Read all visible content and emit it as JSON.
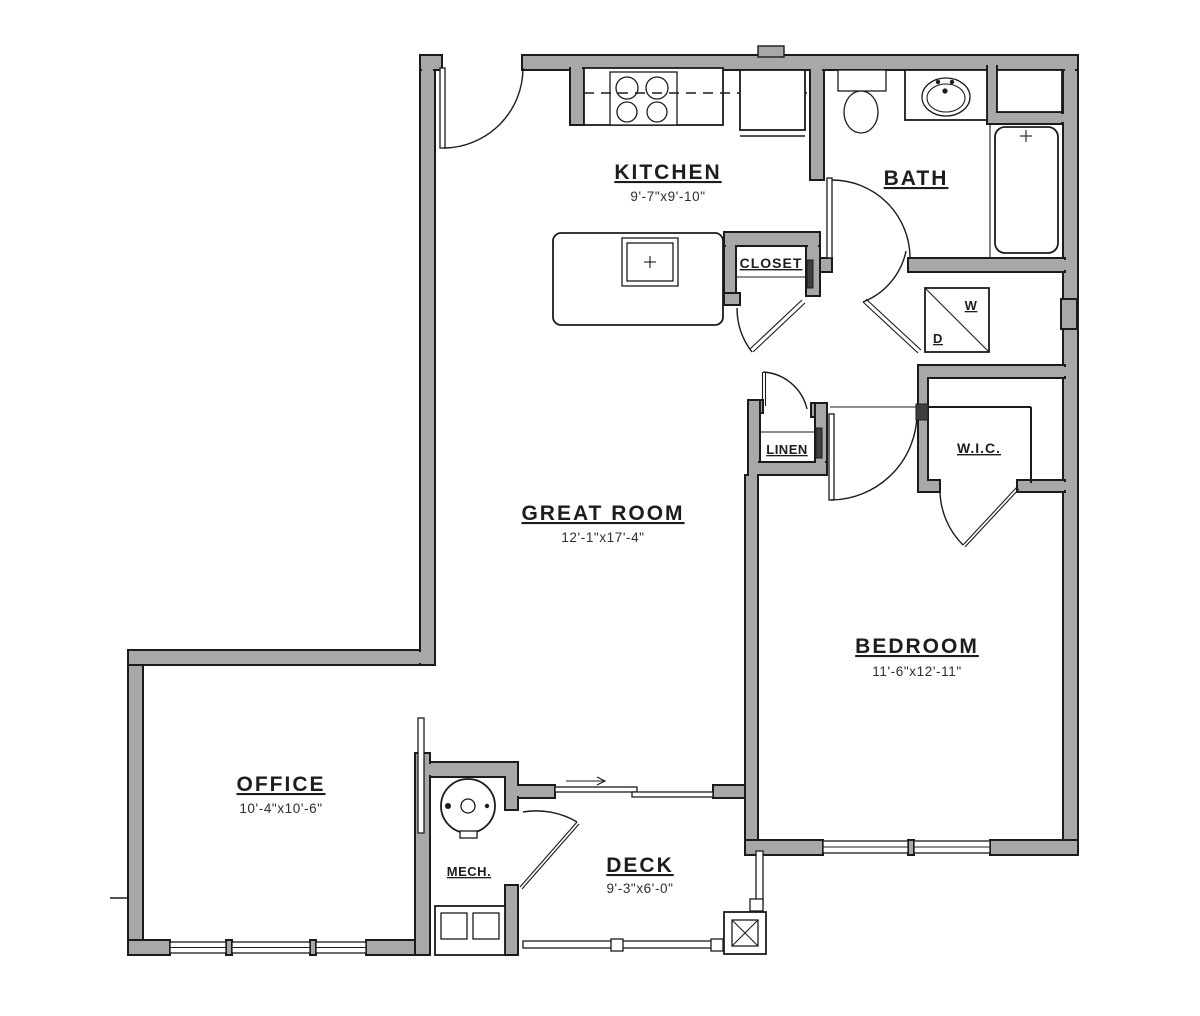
{
  "plan": {
    "title": "one-bedroom apartment floor plan",
    "rooms": {
      "kitchen": {
        "name": "KITCHEN",
        "dims": "9'-7\"x9'-10\""
      },
      "bath": {
        "name": "BATH"
      },
      "closet": {
        "name": "CLOSET"
      },
      "great_room": {
        "name": "GREAT ROOM",
        "dims": "12'-1\"x17'-4\""
      },
      "linen": {
        "name": "LINEN"
      },
      "wic": {
        "name": "W.I.C."
      },
      "bedroom": {
        "name": "BEDROOM",
        "dims": "11'-6\"x12'-11\""
      },
      "office": {
        "name": "OFFICE",
        "dims": "10'-4\"x10'-6\""
      },
      "mech": {
        "name": "MECH."
      },
      "deck": {
        "name": "DECK",
        "dims": "9'-3\"x6'-0\""
      },
      "washer": {
        "name": "W"
      },
      "dryer": {
        "name": "D"
      }
    },
    "colors": {
      "wall_fill": "#a8a8a8",
      "line": "#1b1b1b",
      "background": "#ffffff"
    }
  }
}
